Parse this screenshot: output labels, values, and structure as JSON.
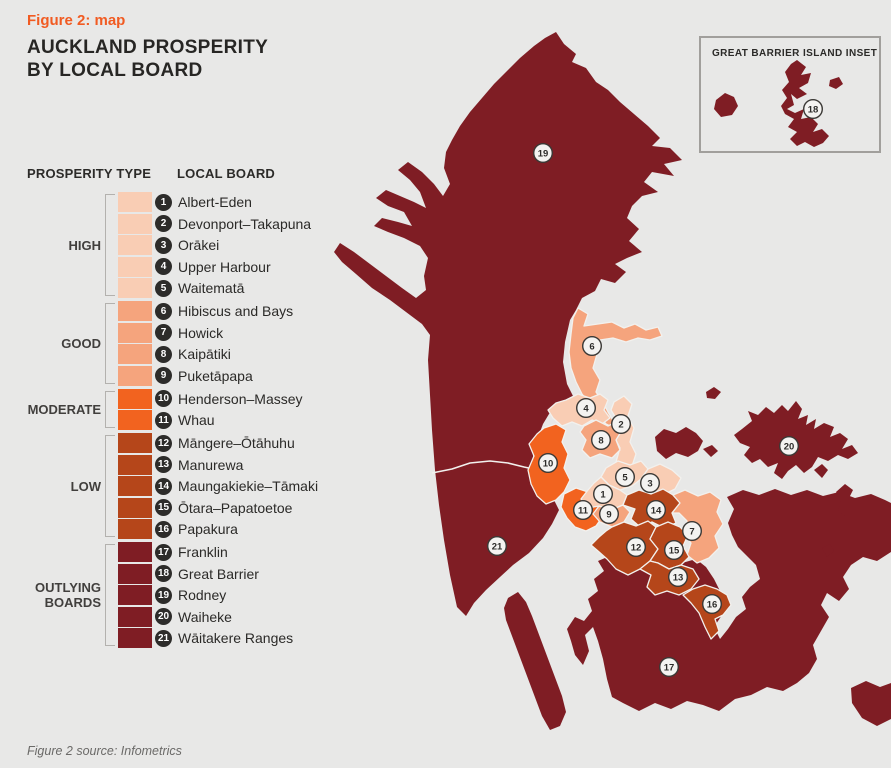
{
  "figure": {
    "kicker": "Figure 2: map",
    "title_line1": "AUCKLAND PROSPERITY",
    "title_line2": "BY LOCAL BOARD",
    "source": "Figure 2 source: Infometrics"
  },
  "colors": {
    "accent": "#f15b22",
    "high": "#f9cdb4",
    "good": "#f5a47d",
    "moderate": "#f2631f",
    "low": "#b5461a",
    "outlying": "#7f1d24",
    "background": "#e8e8e7",
    "badge": "#2d2c2a"
  },
  "legend": {
    "col1_header": "PROSPERITY TYPE",
    "col2_header": "LOCAL BOARD",
    "groups": [
      {
        "label": "HIGH",
        "key": "high",
        "color": "#f9cdb4",
        "boards": [
          {
            "num": 1,
            "name": "Albert-Eden"
          },
          {
            "num": 2,
            "name": "Devonport–Takapuna"
          },
          {
            "num": 3,
            "name": "Orākei"
          },
          {
            "num": 4,
            "name": "Upper Harbour"
          },
          {
            "num": 5,
            "name": "Waitematā"
          }
        ]
      },
      {
        "label": "GOOD",
        "key": "good",
        "color": "#f5a47d",
        "boards": [
          {
            "num": 6,
            "name": "Hibiscus and Bays"
          },
          {
            "num": 7,
            "name": "Howick"
          },
          {
            "num": 8,
            "name": "Kaipātiki"
          },
          {
            "num": 9,
            "name": "Puketāpapa"
          }
        ]
      },
      {
        "label": "MODERATE",
        "key": "moderate",
        "color": "#f2631f",
        "boards": [
          {
            "num": 10,
            "name": "Henderson–Massey"
          },
          {
            "num": 11,
            "name": "Whau"
          }
        ]
      },
      {
        "label": "LOW",
        "key": "low",
        "color": "#b5461a",
        "boards": [
          {
            "num": 12,
            "name": "Māngere–Ōtāhuhu"
          },
          {
            "num": 13,
            "name": "Manurewa"
          },
          {
            "num": 14,
            "name": "Maungakiekie–Tāmaki"
          },
          {
            "num": 15,
            "name": "Ōtara–Papatoetoe"
          },
          {
            "num": 16,
            "name": "Papakura"
          }
        ]
      },
      {
        "label": "OUTLYING BOARDS",
        "key": "outlying",
        "color": "#7f1d24",
        "boards": [
          {
            "num": 17,
            "name": "Franklin"
          },
          {
            "num": 18,
            "name": "Great Barrier"
          },
          {
            "num": 19,
            "name": "Rodney"
          },
          {
            "num": 20,
            "name": "Waiheke"
          },
          {
            "num": 21,
            "name": "Wāitakere Ranges"
          }
        ]
      }
    ]
  },
  "inset": {
    "title": "GREAT BARRIER ISLAND INSET",
    "marker": 18
  },
  "map": {
    "markers": [
      {
        "num": 1,
        "x": 603,
        "y": 494
      },
      {
        "num": 2,
        "x": 621,
        "y": 424
      },
      {
        "num": 3,
        "x": 650,
        "y": 483
      },
      {
        "num": 4,
        "x": 586,
        "y": 408
      },
      {
        "num": 5,
        "x": 625,
        "y": 477
      },
      {
        "num": 6,
        "x": 592,
        "y": 346
      },
      {
        "num": 7,
        "x": 692,
        "y": 531
      },
      {
        "num": 8,
        "x": 601,
        "y": 440
      },
      {
        "num": 9,
        "x": 609,
        "y": 514
      },
      {
        "num": 10,
        "x": 548,
        "y": 463
      },
      {
        "num": 11,
        "x": 583,
        "y": 510
      },
      {
        "num": 12,
        "x": 636,
        "y": 547
      },
      {
        "num": 13,
        "x": 678,
        "y": 577
      },
      {
        "num": 14,
        "x": 656,
        "y": 510
      },
      {
        "num": 15,
        "x": 674,
        "y": 550
      },
      {
        "num": 16,
        "x": 712,
        "y": 604
      },
      {
        "num": 17,
        "x": 669,
        "y": 667
      },
      {
        "num": 18,
        "x": 813,
        "y": 109
      },
      {
        "num": 19,
        "x": 543,
        "y": 153
      },
      {
        "num": 20,
        "x": 789,
        "y": 446
      },
      {
        "num": 21,
        "x": 497,
        "y": 546
      }
    ]
  }
}
